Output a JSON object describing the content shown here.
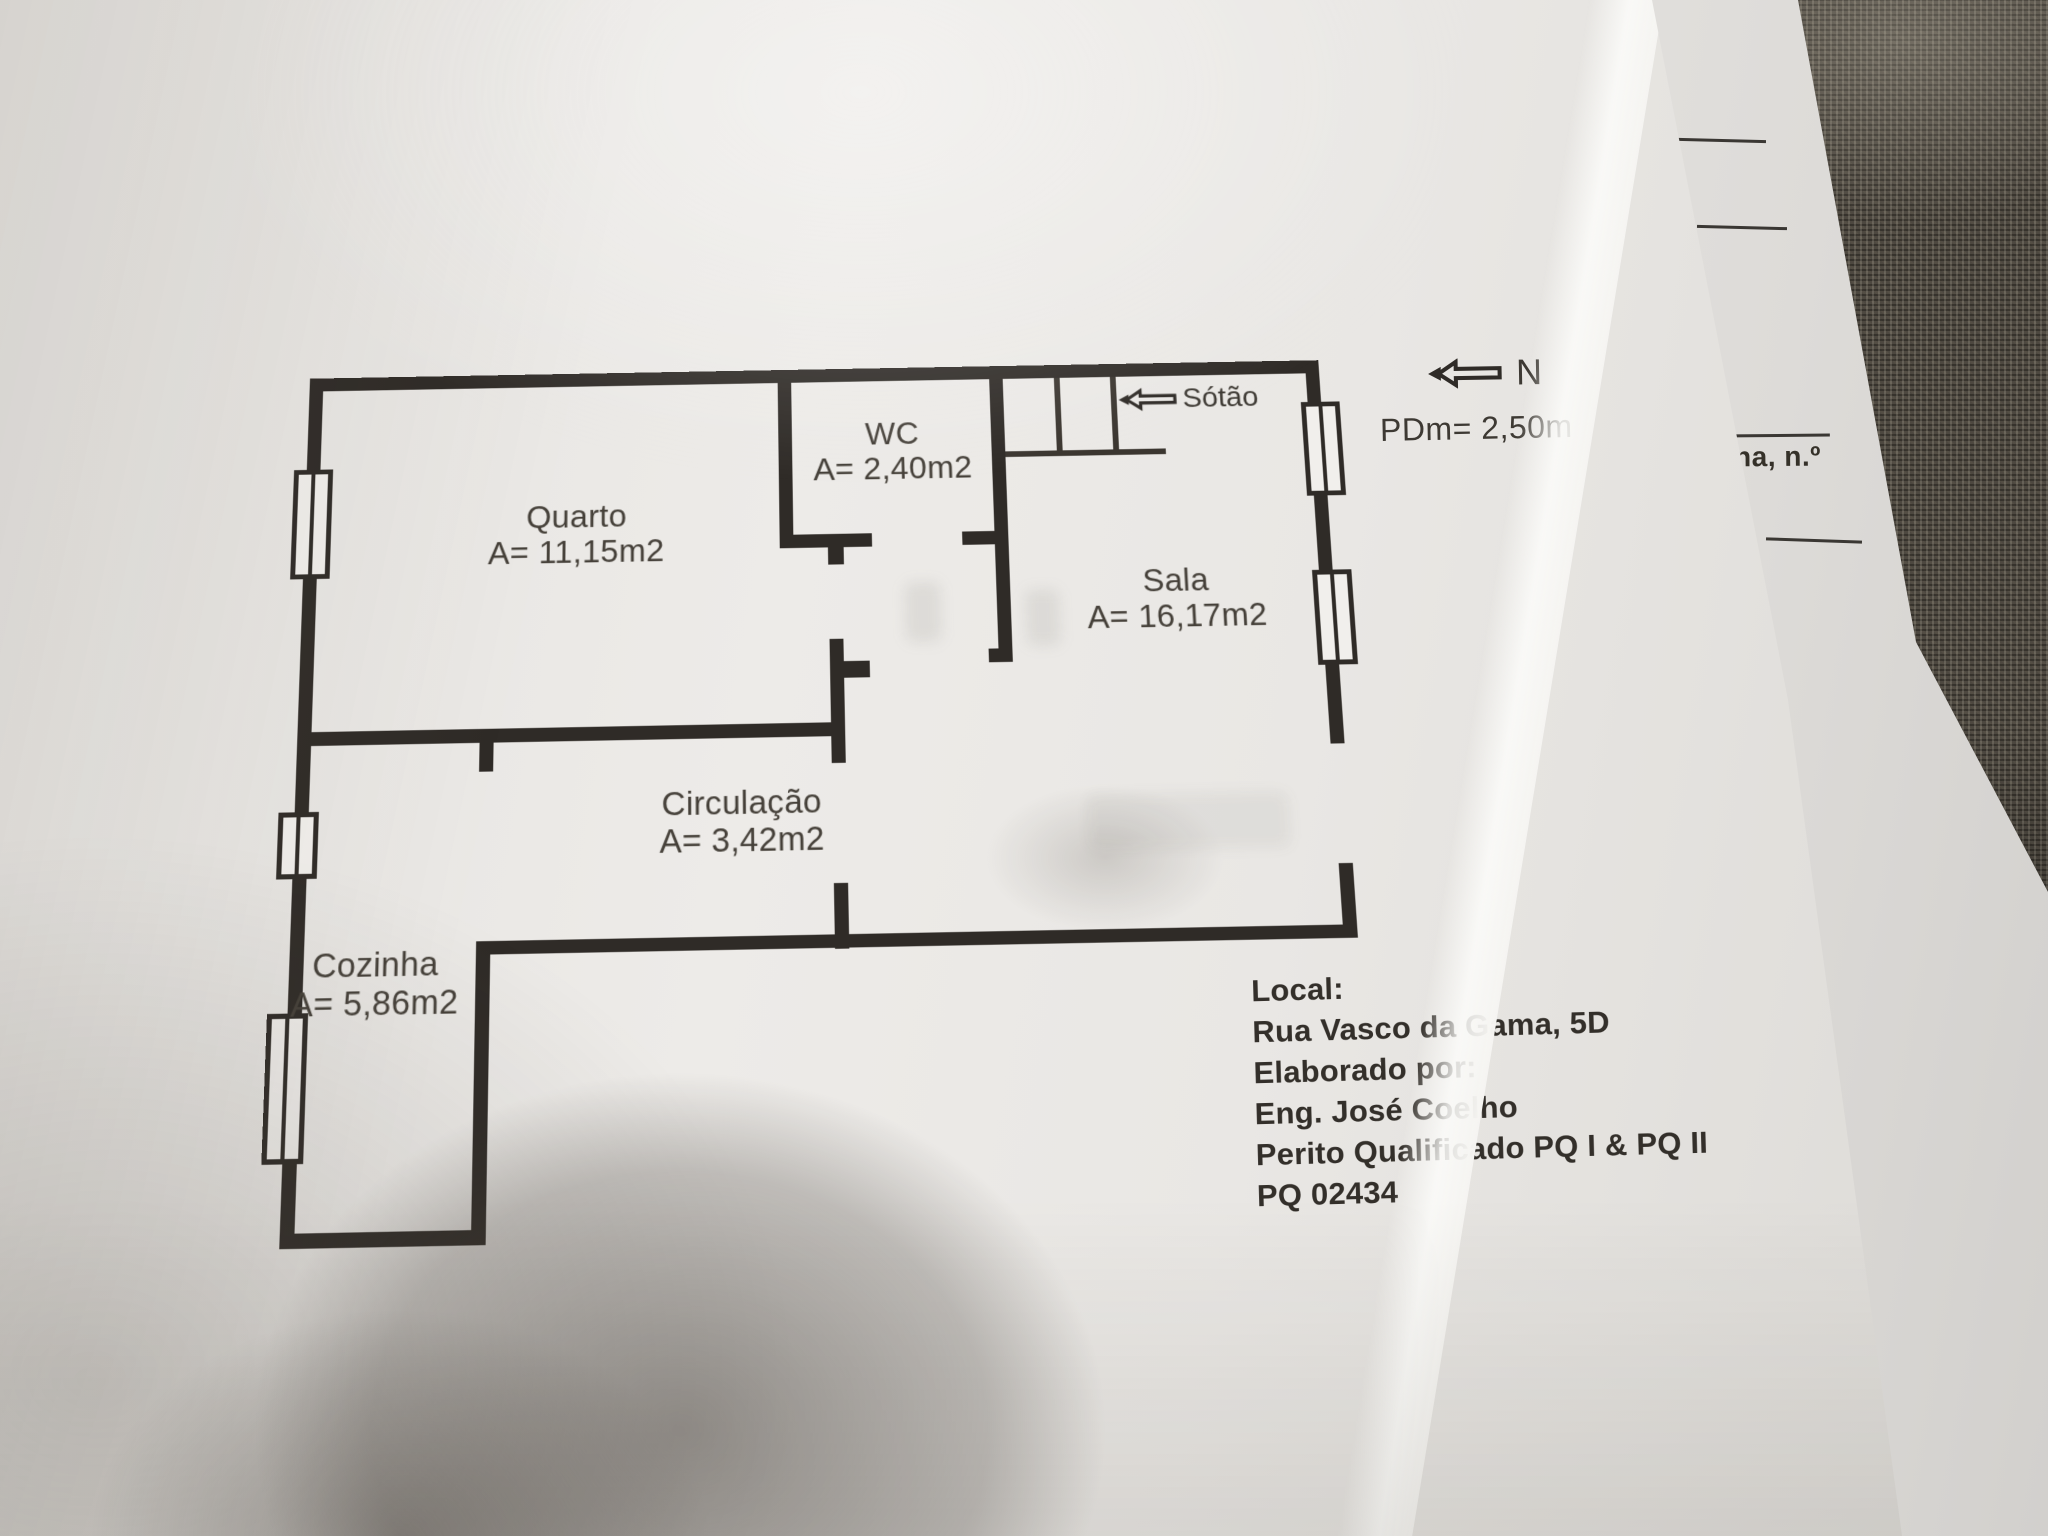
{
  "floor_plan": {
    "rooms": [
      {
        "name": "Quarto",
        "area": "A= 11,15m2"
      },
      {
        "name": "WC",
        "area": "A= 2,40m2"
      },
      {
        "name": "Sala",
        "area": "A= 16,17m2"
      },
      {
        "name": "Circulação",
        "area": "A= 3,42m2"
      },
      {
        "name": "Cozinha",
        "area": "A= 5,86m2"
      }
    ],
    "attic_label": "Sótão",
    "north_label": "N",
    "ceiling_height": "PDm= 2,50m"
  },
  "info_block": {
    "lines": [
      "Local:",
      "Rua Vasco da Gama, 5D",
      "Elaborado por:",
      "Eng. José Coelho",
      "Perito Qualificado PQ I & PQ II",
      "PQ 02434"
    ]
  },
  "side_sheet": {
    "partial_text": "ana, n.º"
  },
  "colors": {
    "wall": "#2f2b27",
    "paper": "#e9e7e4",
    "underlying_sheet": "#efede9",
    "fabric": "#4d4840",
    "ink": "#3d3933"
  }
}
